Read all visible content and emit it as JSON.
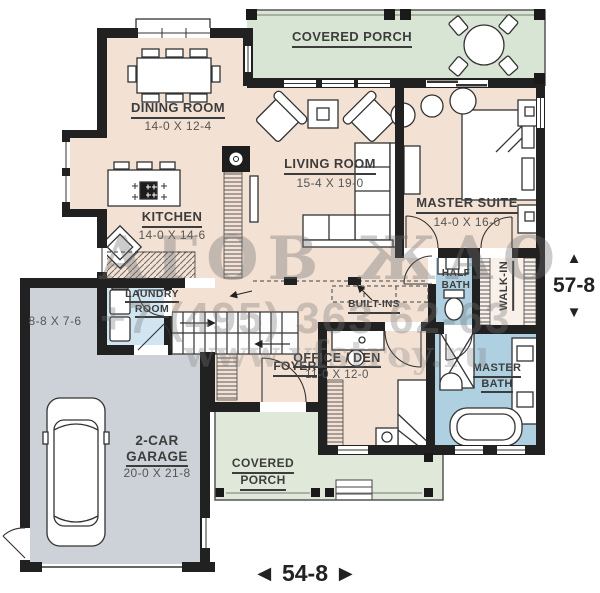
{
  "watermark": {
    "logo": "АГОВ ЖАО",
    "phone": "+7 (495) 363 62-63",
    "site": "www.vfstroy.ru"
  },
  "rooms": {
    "covered_porch_top": {
      "label": "COVERED PORCH"
    },
    "dining": {
      "label": "DINING ROOM",
      "dims": "14-0 X 12-4"
    },
    "living": {
      "label": "LIVING ROOM",
      "dims": "15-4 X 19-0"
    },
    "master_suite": {
      "label": "MASTER SUITE",
      "dims": "14-0 X 16-0"
    },
    "kitchen": {
      "label": "KITCHEN",
      "dims": "14-0 X 14-6"
    },
    "laundry": {
      "line1": "LAUNDRY",
      "line2": "ROOM"
    },
    "half_bath": {
      "line1": "HALF",
      "line2": "BATH"
    },
    "walk_in": {
      "label": "WALK-IN"
    },
    "built_ins": {
      "label": "BUILT-INS"
    },
    "office": {
      "label": "OFFICE / DEN",
      "dims": "11-0 X 12-0"
    },
    "master_bath": {
      "line1": "MASTER",
      "line2": "BATH"
    },
    "foyer": {
      "label": "FOYER"
    },
    "garage": {
      "line1": "2-CAR",
      "line2": "GARAGE",
      "dims": "20-0 X 21-8"
    },
    "garage_nook": {
      "dims": "8-8 X 7-6"
    },
    "covered_porch_bottom": {
      "line1": "COVERED",
      "line2": "PORCH"
    }
  },
  "dimensions": {
    "right": {
      "value": "57-8",
      "arrow_up": "▲",
      "arrow_down": "▼"
    },
    "bottom": {
      "value": "54-8",
      "arrow_left": "◄",
      "arrow_right": "►"
    }
  },
  "colors": {
    "wall": "#212121",
    "floor": "#f3e1d4",
    "porch": "#d9e5d4",
    "porch_bottom": "#dfe8d9",
    "garage": "#ccd2d8",
    "bath": "#aed0e0",
    "laundry": "#d0e5f0",
    "walk_in": "#f8f0e9"
  }
}
